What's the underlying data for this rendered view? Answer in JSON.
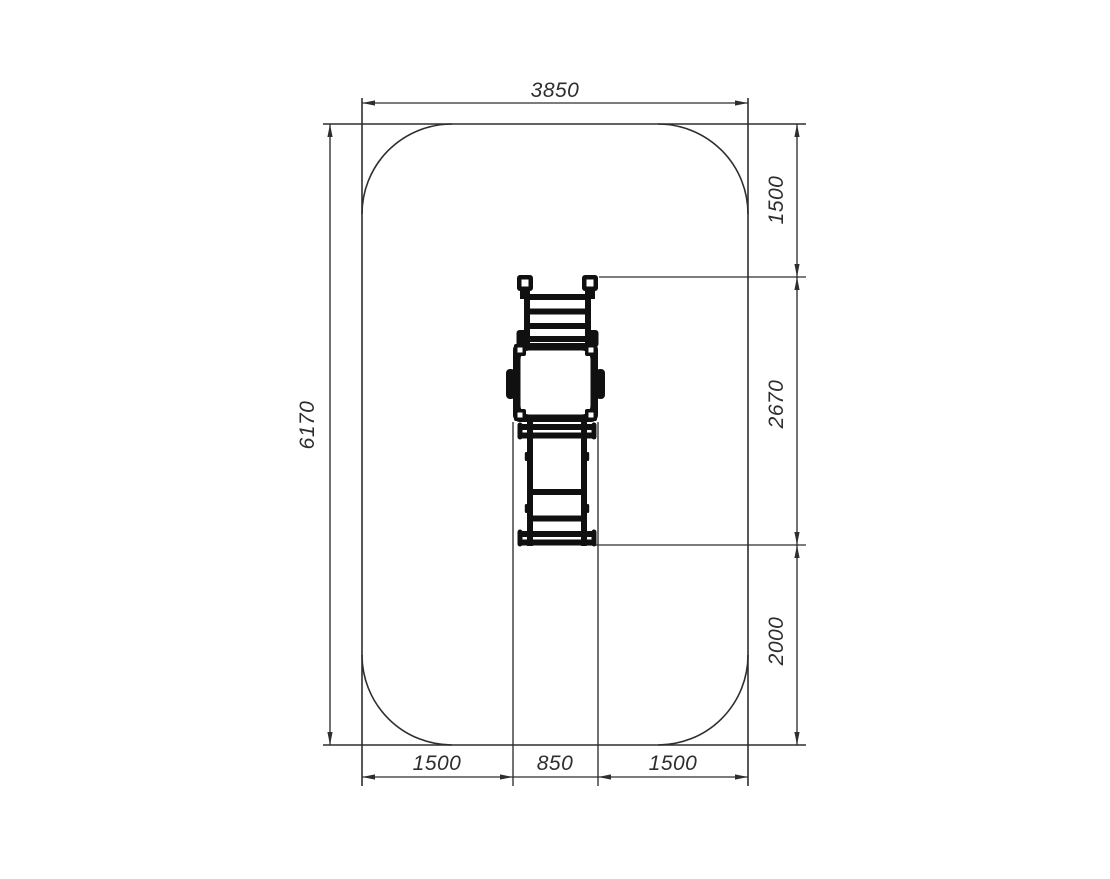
{
  "drawing": {
    "type": "plan-view-technical-drawing",
    "subject": "playground-slide-safety-zone",
    "safety_zone": {
      "width_label": "3850",
      "height_label": "6170"
    },
    "right_dimensions": [
      {
        "label": "1500"
      },
      {
        "label": "2670"
      },
      {
        "label": "2000"
      }
    ],
    "bottom_dimensions": [
      {
        "label": "1500"
      },
      {
        "label": "850"
      },
      {
        "label": "1500"
      }
    ],
    "colors": {
      "line": "#2e2e2e",
      "equipment": "#101010",
      "background": "#ffffff"
    }
  }
}
